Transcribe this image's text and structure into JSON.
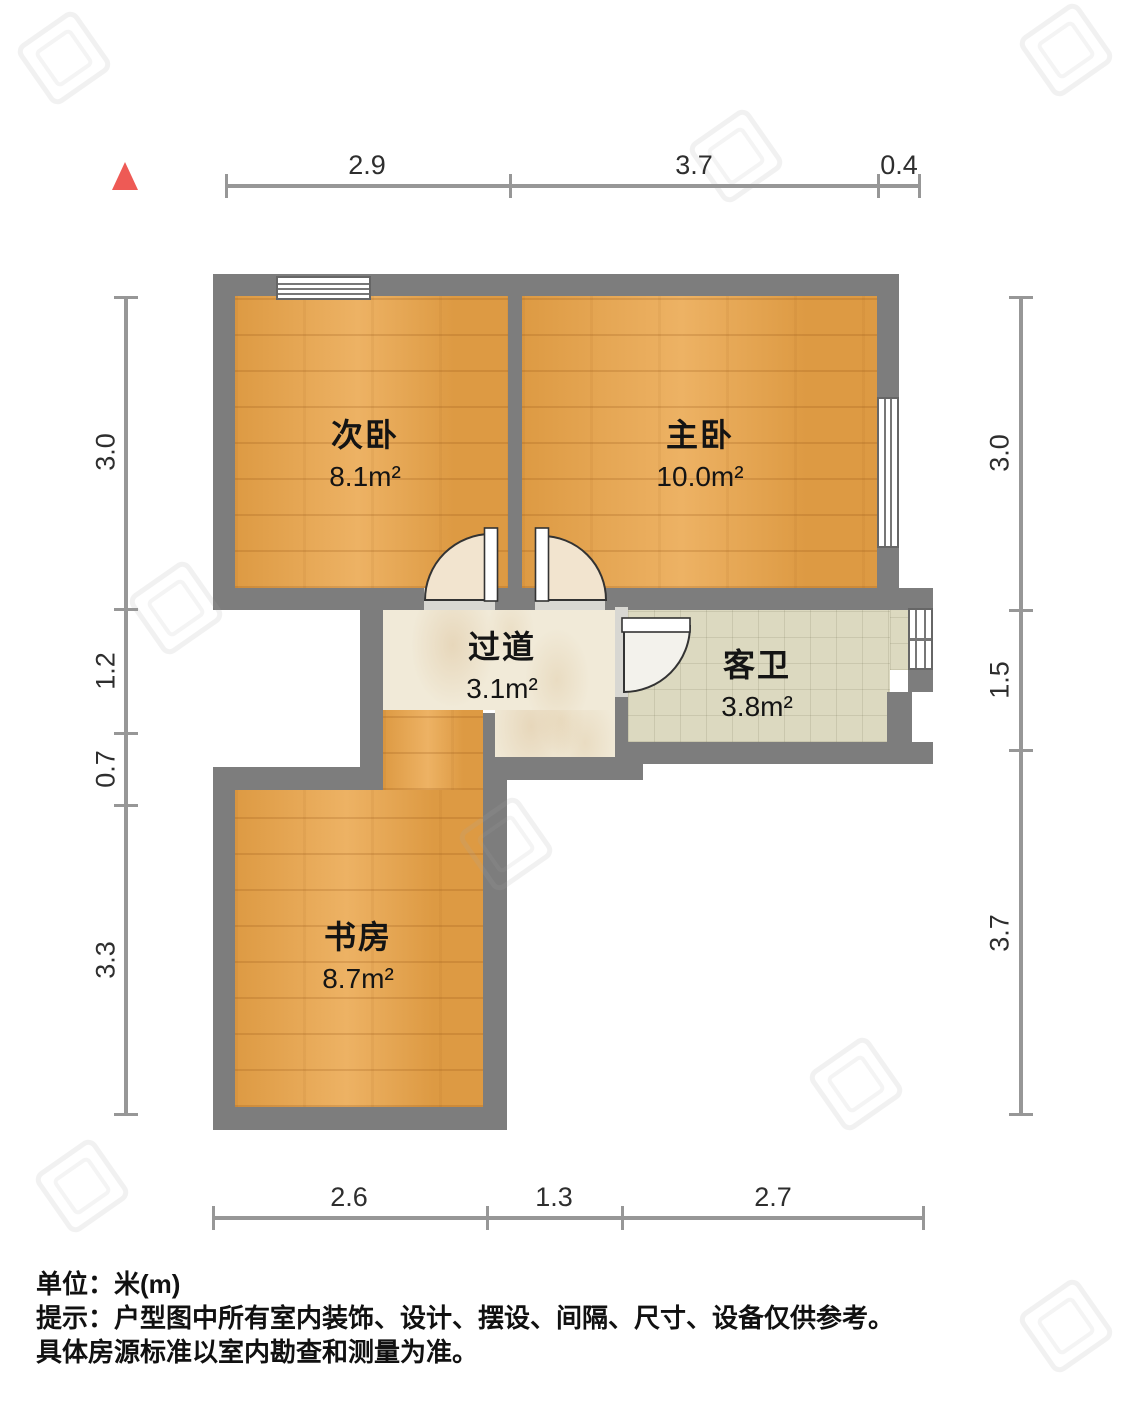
{
  "rooms": [
    {
      "name": "次卧",
      "area": "8.1m²"
    },
    {
      "name": "主卧",
      "area": "10.0m²"
    },
    {
      "name": "过道",
      "area": "3.1m²"
    },
    {
      "name": "客卫",
      "area": "3.8m²"
    },
    {
      "name": "书房",
      "area": "8.7m²"
    }
  ],
  "dimensions": {
    "top": [
      "2.9",
      "3.7",
      "0.4"
    ],
    "bottom": [
      "2.6",
      "1.3",
      "2.7"
    ],
    "left": [
      "3.0",
      "1.2",
      "0.7",
      "3.3"
    ],
    "right": [
      "3.0",
      "1.5",
      "3.7"
    ]
  },
  "notes": {
    "unit": "单位：米(m)",
    "tip_line1": "提示：户型图中所有室内装饰、设计、摆设、间隔、尺寸、设备仅供参考。",
    "tip_line2": "具体房源标准以室内勘查和测量为准。"
  },
  "colors": {
    "wall": "#7d7d7d",
    "wood_floor": "#e2a14e",
    "marble_floor": "#f1ead8",
    "tile_floor": "#dcd9c0",
    "north_arrow": "#ee5a55",
    "dim_line": "#979797"
  }
}
